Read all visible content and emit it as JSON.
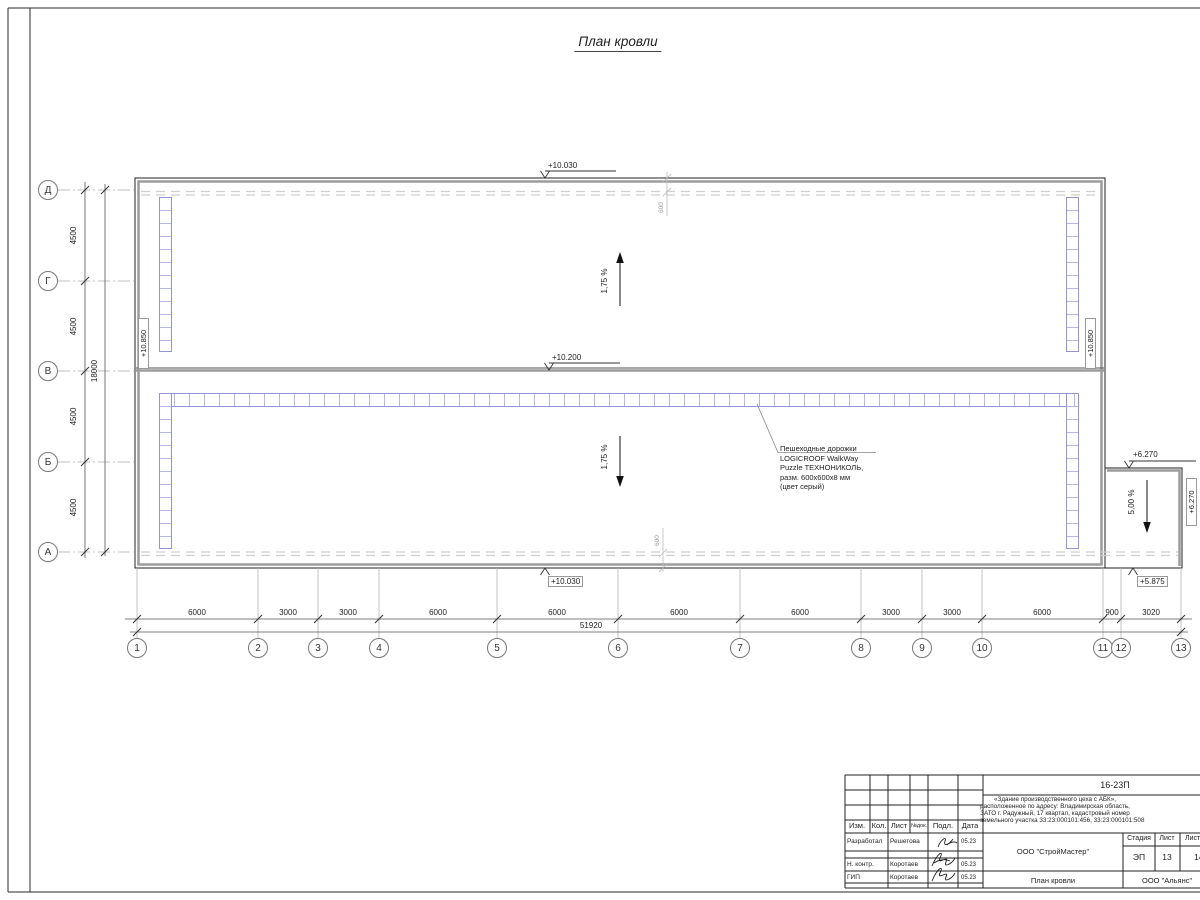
{
  "title": "План кровли",
  "grid": {
    "columns": [
      "1",
      "2",
      "3",
      "4",
      "5",
      "6",
      "7",
      "8",
      "9",
      "10",
      "11",
      "12",
      "13"
    ],
    "rows": [
      "Д",
      "Г",
      "В",
      "Б",
      "А"
    ]
  },
  "dims": {
    "bottom": [
      "6000",
      "3000",
      "3000",
      "6000",
      "6000",
      "6000",
      "6000",
      "3000",
      "3000",
      "6000",
      "900",
      "3020"
    ],
    "bottom_total": "51920",
    "left": [
      "4500",
      "4500",
      "4500",
      "4500"
    ],
    "left_total": "18000",
    "parapet_top": "600",
    "parapet_bottom": "600"
  },
  "elevations": {
    "top": "+10.030",
    "ridge": "+10.200",
    "bottom": "+10.030",
    "left": "+10.850",
    "right": "+10.850",
    "annex_top": "+6.270",
    "annex_right": "+6.270",
    "annex_bottom": "+5.875"
  },
  "slopes": {
    "main_upper": "1,75 %",
    "main_lower": "1,75 %",
    "annex": "5,00 %"
  },
  "annotation": {
    "lines": [
      "Пешеходные дорожки",
      "LOGICROOF WalkWay",
      "Puzzle ТЕХНОНИКОЛЬ,",
      "разм. 600х600х8 мм",
      "(цвет серый)"
    ]
  },
  "title_block": {
    "doc_number": "16-23П",
    "description_lines": [
      "«Здание производственного цеха с АБК»,",
      "расположенное по адресу: Владимирская область,",
      "ЗАТО г. Радужный, 17 квартал, кадастровый номер",
      "земельного участка 33:23:000101:456, 33:23:000101:508"
    ],
    "headers": [
      "Изм.",
      "Кол.",
      "Лист",
      "№док.",
      "Подл.",
      "Дата"
    ],
    "rows": [
      {
        "role": "Разработал",
        "name": "Решетова",
        "date": "05.23"
      },
      {
        "role": "Н. контр.",
        "name": "Коротаев",
        "date": "05.23"
      },
      {
        "role": "ГИП",
        "name": "Коротаев",
        "date": "05.23"
      }
    ],
    "org": "ООО \"СтройМастер\"",
    "sheet_title": "План кровли",
    "client": "ООО \"Альянс\"",
    "stage_label": "Стадия",
    "sheet_label": "Лист",
    "sheets_label": "Листов",
    "stage": "ЭП",
    "sheet": "13",
    "sheets": "14"
  }
}
